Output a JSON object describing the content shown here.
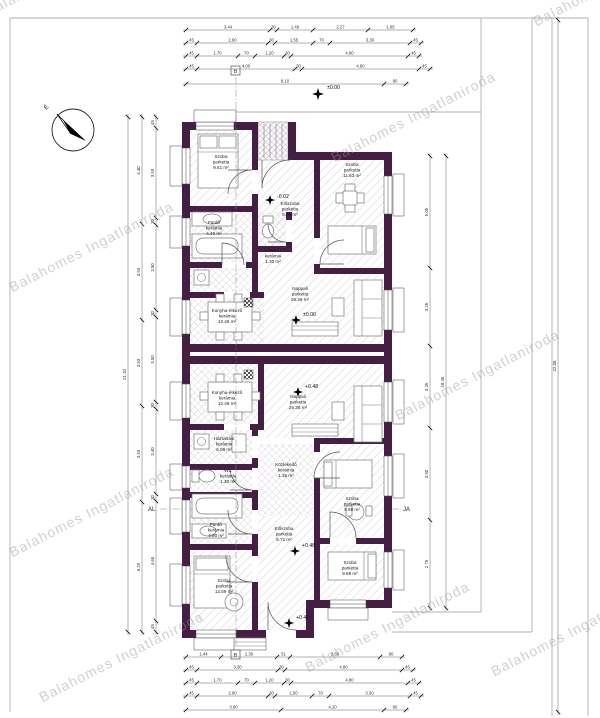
{
  "watermark": {
    "text": "Balahomes Ingatlaniroda"
  },
  "compass": {
    "label": "É"
  },
  "markers": {
    "left": "AL",
    "right": "JA",
    "section_top": "B",
    "section_bottom": "B"
  },
  "elevations": {
    "site": "±0.00",
    "entry_upper": "-0.02",
    "nappali_upper": "±0.00",
    "nappali_lower": "+0.48",
    "eloszoba_lower": "+0.48",
    "entry_lower": "+0.46"
  },
  "rooms": {
    "u_szoba1": {
      "name": "Szoba",
      "material": "parketta",
      "area": "9.61 m²"
    },
    "u_furdo": {
      "name": "Fürdő",
      "material": "kerámia",
      "area": "4.40 m²"
    },
    "u_wc": {
      "name": "WC",
      "material": "kerámia",
      "area": "1.30 m²"
    },
    "u_eloszoba": {
      "name": "Előszoba",
      "material": "parketta",
      "area": "5.65 m²"
    },
    "u_szoba2": {
      "name": "Szoba",
      "material": "parketta",
      "area": "11.63 m²"
    },
    "u_konyha": {
      "name": "Konyha-étkező",
      "material": "kerámia",
      "area": "10.48 m²"
    },
    "u_nappali": {
      "name": "Nappali",
      "material": "parketta",
      "area": "26.36 m²"
    },
    "l_konyha": {
      "name": "Konyha-étkező",
      "material": "kerámia",
      "area": "10.48 m²"
    },
    "l_nappali": {
      "name": "Nappali",
      "material": "parketta",
      "area": "26.36 m²"
    },
    "l_haztartasi": {
      "name": "Háztartási",
      "material": "kerámia",
      "area": "6.09 m²"
    },
    "l_wc": {
      "name": "WC",
      "material": "kerámia",
      "area": "1.30 m²"
    },
    "l_kozlekedo": {
      "name": "Közlekedő",
      "material": "kerámia",
      "area": "1.36 m²"
    },
    "l_furdo": {
      "name": "Fürdő",
      "material": "kerámia",
      "area": "4.90 m²"
    },
    "l_szoba1": {
      "name": "Szoba",
      "material": "parketta",
      "area": "9.68 m²"
    },
    "l_eloszoba": {
      "name": "Előszoba",
      "material": "parketta",
      "area": "5.71 m²"
    },
    "l_szoba2": {
      "name": "Szoba",
      "material": "parketta",
      "area": "12.59 m²"
    },
    "l_szoba3": {
      "name": "Szoba",
      "material": "parketta",
      "area": "9.69 m²"
    }
  },
  "dims": {
    "top": [
      [
        "3.44",
        "30",
        "1.49",
        "2.27",
        "1.85"
      ],
      [
        "45",
        "2.90",
        "30",
        "1.55",
        "70",
        "3.30",
        "45"
      ],
      [
        "45",
        "1.70",
        "70",
        "1.20",
        "30",
        "4.80",
        "45"
      ],
      [
        "45",
        "4.00",
        "30",
        "4.80",
        "45"
      ],
      [
        "8.10",
        "90"
      ]
    ],
    "bottom": [
      [
        "1.44",
        "2.30",
        "51",
        "3.69",
        "90"
      ],
      [
        "45",
        "3.30",
        "30",
        "4.80",
        "45"
      ],
      [
        "45",
        "1.70",
        "70",
        "1.20",
        "30",
        "4.80",
        "45"
      ],
      [
        "45",
        "2.90",
        "30",
        "1.50",
        "70",
        "3.30",
        "45"
      ],
      [
        "3.90",
        "4.20",
        "90"
      ]
    ],
    "left": [
      [
        "21.10"
      ],
      [
        "4.40",
        "3.93",
        "3.53",
        "3.93",
        "5.29"
      ],
      [
        "45",
        "3.93",
        "30",
        "3.50",
        "30",
        "3.50",
        "30",
        "3.40",
        "30",
        "4.65",
        "45"
      ]
    ],
    "right": [
      [
        "5.05",
        "3.25",
        "3.45",
        "3.90",
        "2.75"
      ],
      [
        "18.45"
      ],
      [
        "22.08"
      ]
    ]
  }
}
